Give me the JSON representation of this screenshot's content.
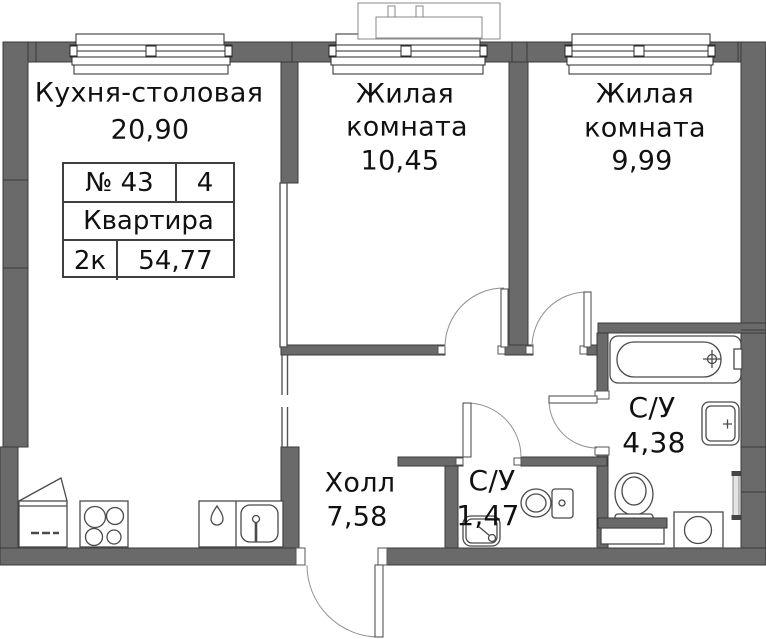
{
  "title": "План квартиры",
  "colors": {
    "wall": "#6a6a6a",
    "wall_edge": "#3a3a3a",
    "fixture_line": "#4a4a4a",
    "door_arc": "#909090",
    "text": "#111111",
    "background": "#ffffff"
  },
  "labels": {
    "kitchen": {
      "name": "Кухня-столовая",
      "area": "20,90"
    },
    "living1": {
      "line1": "Жилая",
      "line2": "комната",
      "area": "10,45"
    },
    "living2": {
      "line1": "Жилая",
      "line2": "комната",
      "area": "9,99"
    },
    "hall": {
      "name": "Холл",
      "area": "7,58"
    },
    "wc_small": {
      "name": "С/У",
      "area": "1,47"
    },
    "wc_large": {
      "name": "С/У",
      "area": "4,38"
    }
  },
  "info_table": {
    "apt_number": "№ 43",
    "floor": "4",
    "kind": "Квартира",
    "rooms": "2к",
    "total_area": "54,77"
  },
  "icons": [
    "window",
    "door-swing",
    "ac-unit",
    "bathtub",
    "toilet",
    "washbasin",
    "kitchen-sink",
    "water-drop",
    "stove",
    "fridge",
    "washing-machine",
    "towel-rail"
  ]
}
